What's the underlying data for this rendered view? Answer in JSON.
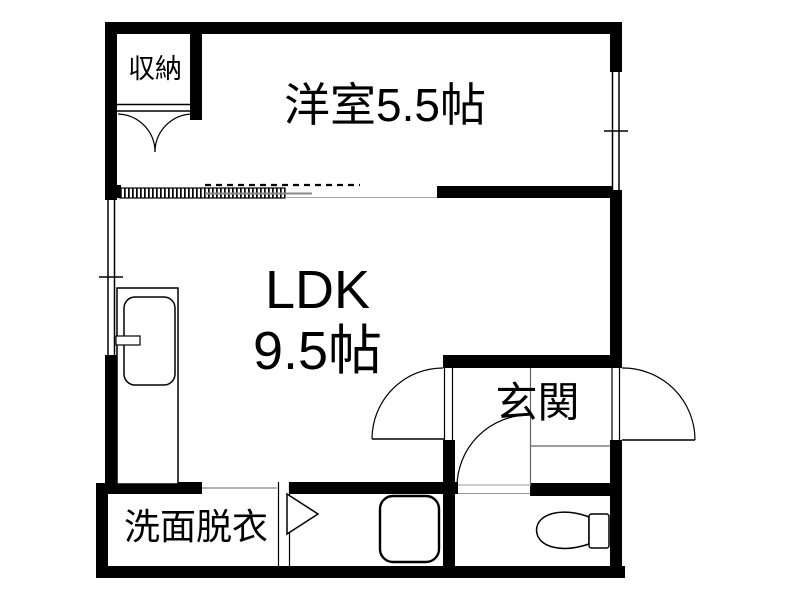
{
  "plan": {
    "type": "apartment-floorplan",
    "rooms": {
      "closet": {
        "label": "収納"
      },
      "western": {
        "label": "洋室5.5帖"
      },
      "ldk": {
        "line1": "LDK",
        "line2": "9.5帖"
      },
      "genkan": {
        "label": "玄関"
      },
      "washroom": {
        "label": "洗面脱衣"
      }
    },
    "fixtures": [
      "kitchen-sink",
      "bathtub",
      "toilet",
      "closet-double-doors",
      "sliding-door-track",
      "ldk-genkan-door",
      "front-door",
      "toilet-door",
      "bath-folding-door",
      "window-left",
      "window-right",
      "genkan-step-lines"
    ],
    "colors": {
      "wall": "#000000",
      "background": "#ffffff",
      "thin_line": "#000000",
      "step_line": "#666666",
      "track_line": "#888888"
    }
  }
}
